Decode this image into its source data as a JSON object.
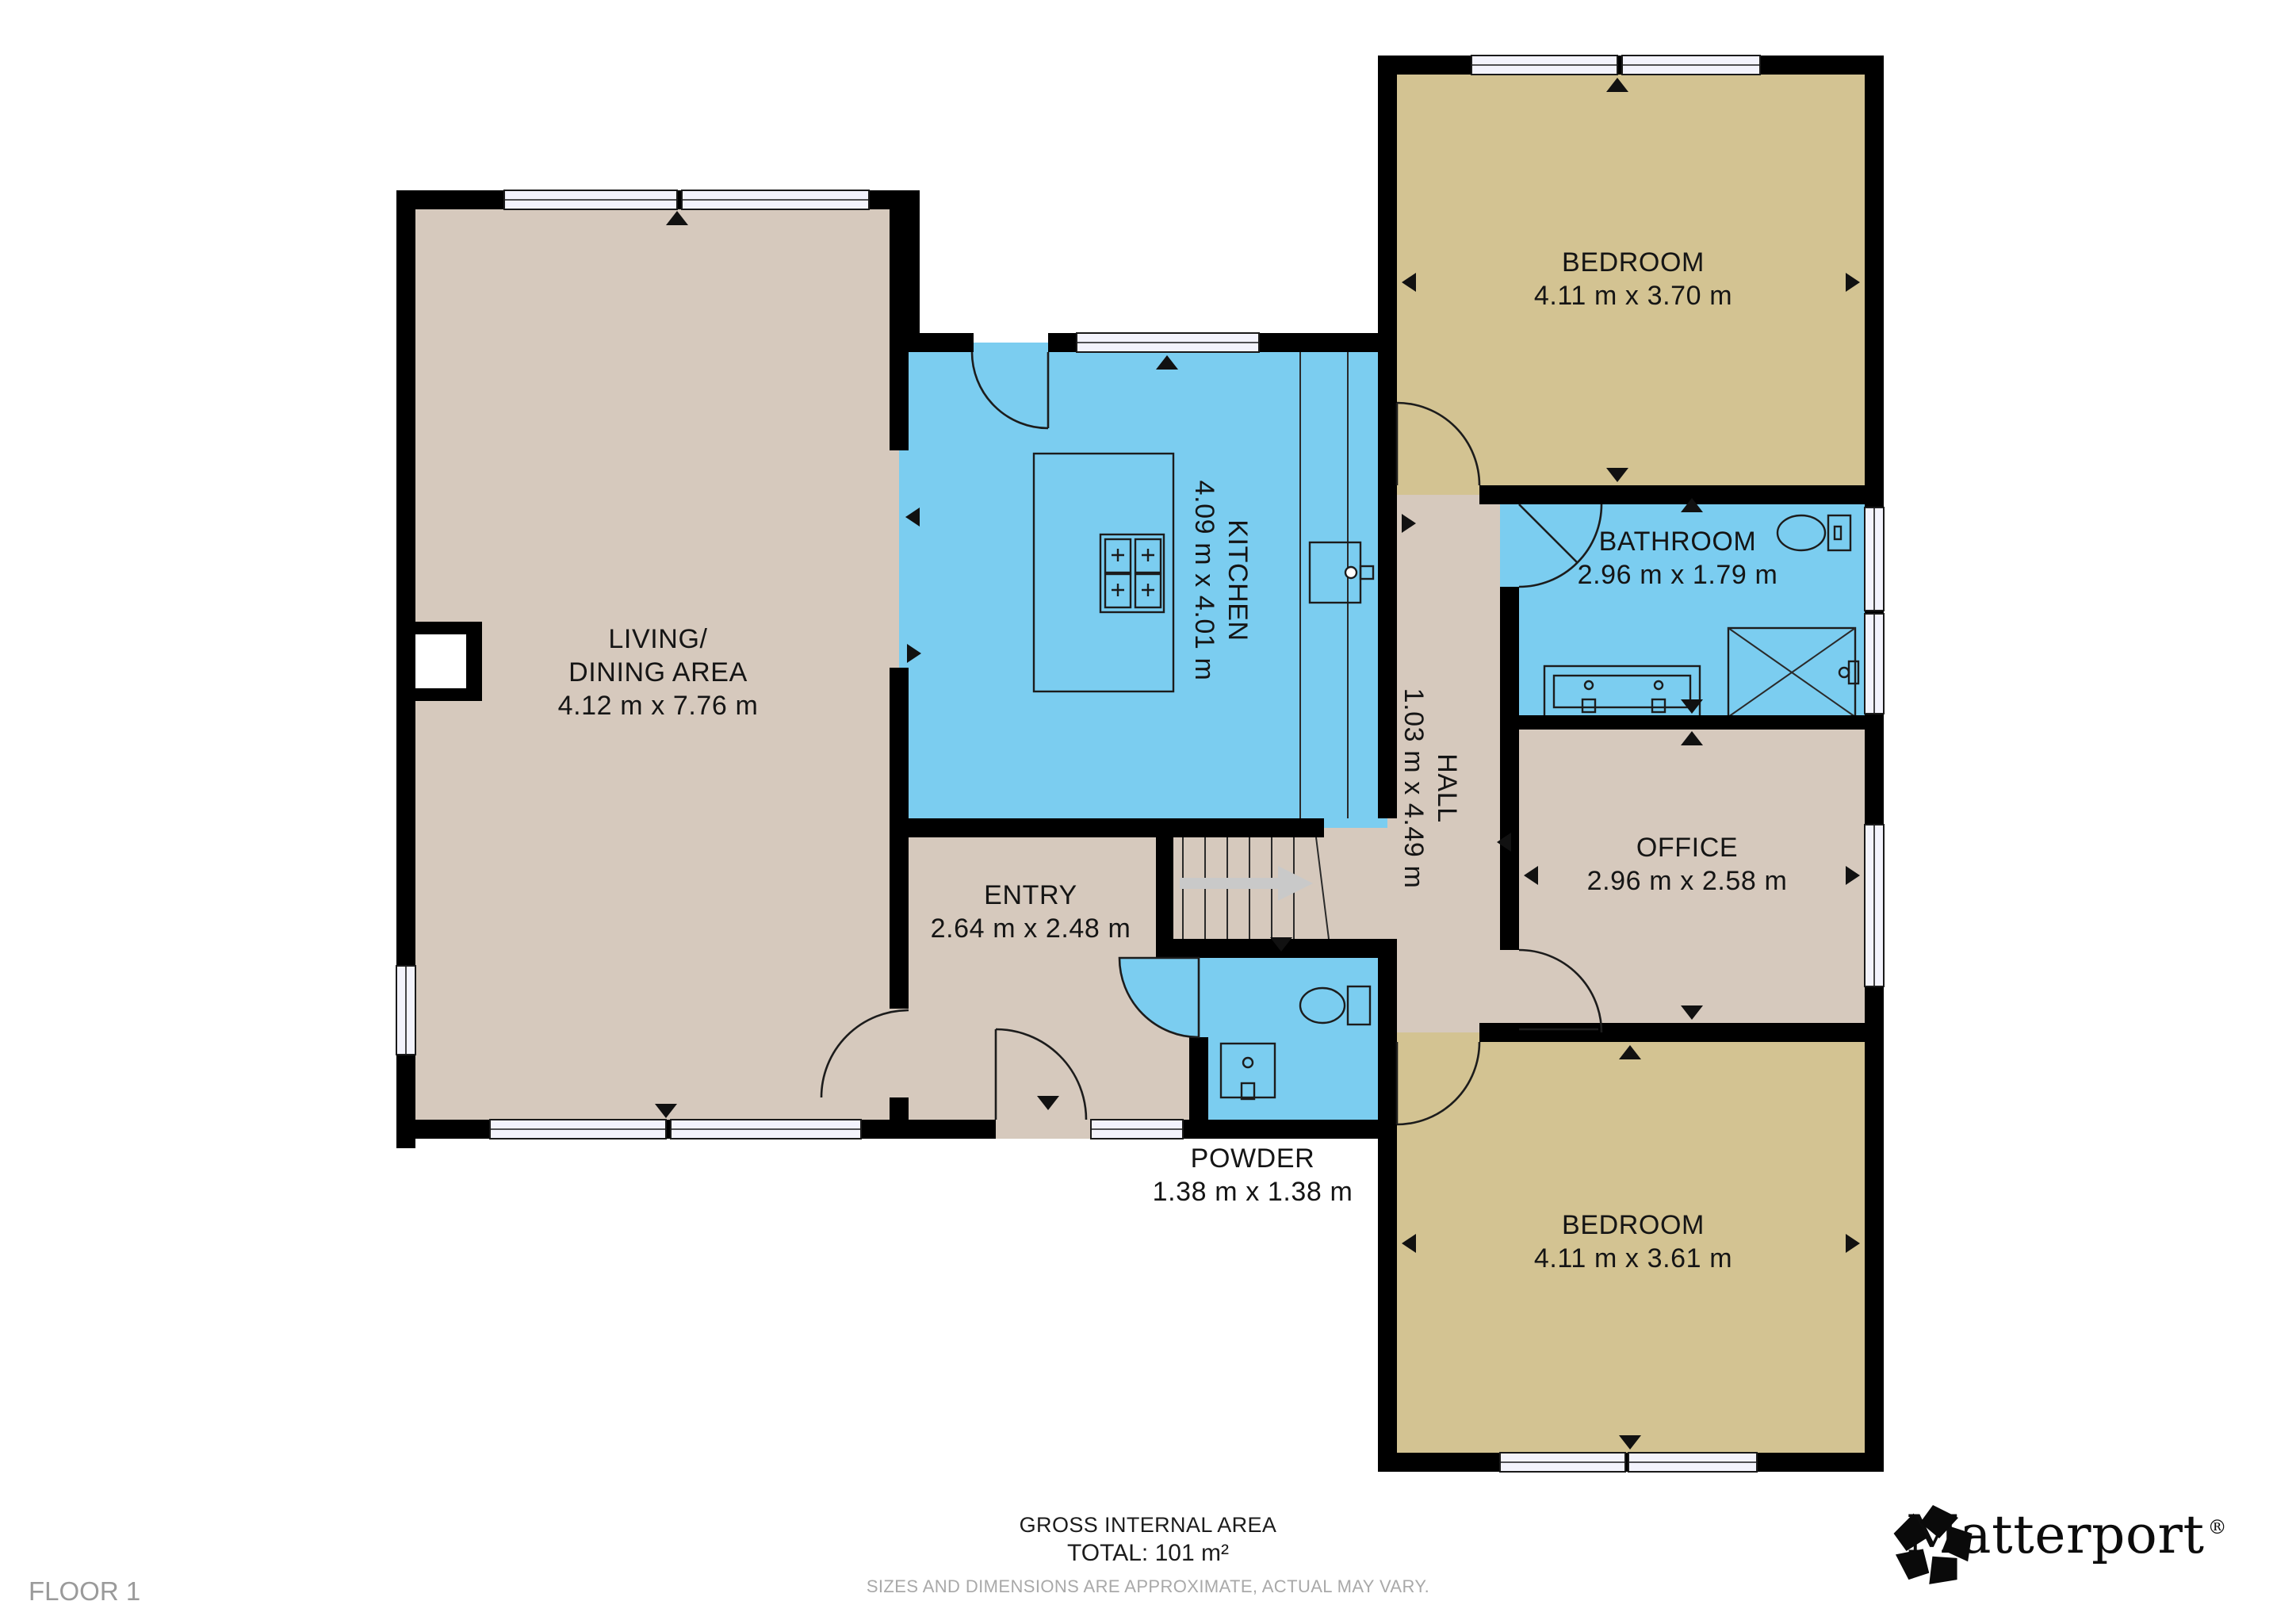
{
  "floor_label": "FLOOR 1",
  "footer": {
    "gross_label": "GROSS INTERNAL AREA",
    "total_label": "TOTAL: 101 m²",
    "disclaimer": "SIZES AND DIMENSIONS ARE APPROXIMATE, ACTUAL MAY VARY."
  },
  "brand": {
    "wordmark": "Matterport",
    "reg": "®"
  },
  "rooms": {
    "living": {
      "line1": "LIVING/",
      "line2": "DINING AREA",
      "dims": "4.12 m x 7.76 m"
    },
    "kitchen": {
      "name": "KITCHEN",
      "dims": "4.09 m x 4.01 m"
    },
    "entry": {
      "name": "ENTRY",
      "dims": "2.64 m x 2.48 m"
    },
    "hall": {
      "name": "HALL",
      "dims": "1.03 m x 4.49 m"
    },
    "bathroom": {
      "name": "BATHROOM",
      "dims": "2.96 m x 1.79 m"
    },
    "office": {
      "name": "OFFICE",
      "dims": "2.96 m x 2.58 m"
    },
    "powder": {
      "name": "POWDER",
      "dims": "1.38 m x 1.38 m"
    },
    "bedroom_top": {
      "name": "BEDROOM",
      "dims": "4.11 m x 3.70 m"
    },
    "bedroom_bottom": {
      "name": "BEDROOM",
      "dims": "4.11 m x 3.61 m"
    }
  },
  "colors": {
    "room_beige": "#d6c9bd",
    "room_khaki": "#d3c392",
    "room_blue": "#7bcdf0",
    "wall": "#000000",
    "window_fill": "#f3f3fc",
    "gray_label": "#9a9a9a",
    "disclaimer": "#a9a9a9",
    "stairs_arrow": "#c9c9c9"
  }
}
